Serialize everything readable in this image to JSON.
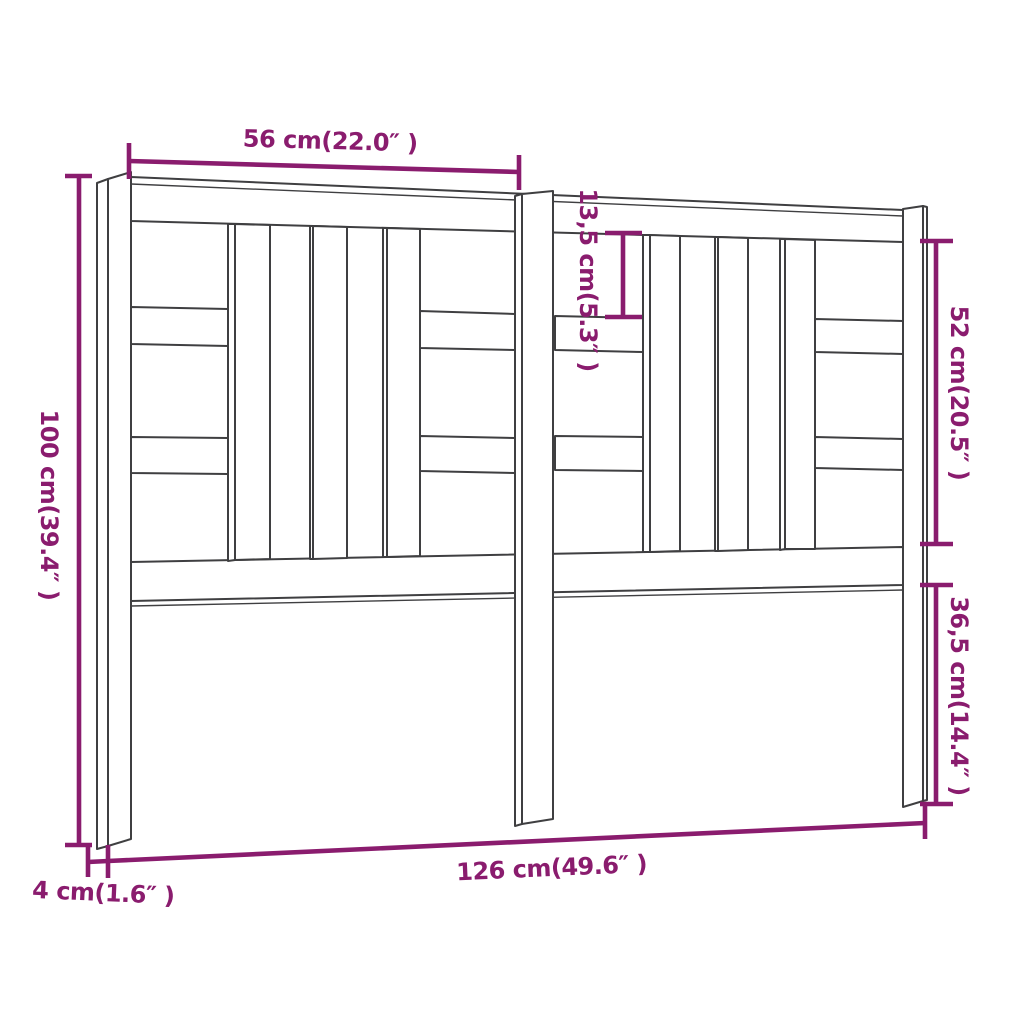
{
  "figure": {
    "kind": "furniture dimension diagram",
    "object": "bed headboard line drawing",
    "background": "#ffffff",
    "drawing_line_color": "#3f3f41",
    "accent_color": "#8a1c6e"
  },
  "dims": {
    "top_width": {
      "label": "56 cm(22.0″ )",
      "value_cm": 56,
      "value_in": 22.0,
      "measures": "half width, leg to center post"
    },
    "height": {
      "label": "100 cm(39.4″ )",
      "value_cm": 100,
      "value_in": 39.4,
      "measures": "total height"
    },
    "slat_offset": {
      "label": "13,5 cm(5.3″ )",
      "value_cm": 13.5,
      "value_in": 5.3,
      "measures": "top rail to first cross rail"
    },
    "panel_height": {
      "label": "52 cm(20.5″ )",
      "value_cm": 52,
      "value_in": 20.5,
      "measures": "panel height between rails"
    },
    "leg_clearance": {
      "label": "36,5 cm(14.4″ )",
      "value_cm": 36.5,
      "value_in": 14.4,
      "measures": "bottom rail to floor"
    },
    "total_width": {
      "label": "126 cm(49.6″ )",
      "value_cm": 126,
      "value_in": 49.6,
      "measures": "total width"
    },
    "leg_thickness": {
      "label": "4 cm(1.6″ )",
      "value_cm": 4,
      "value_in": 1.6,
      "measures": "leg thickness"
    }
  }
}
